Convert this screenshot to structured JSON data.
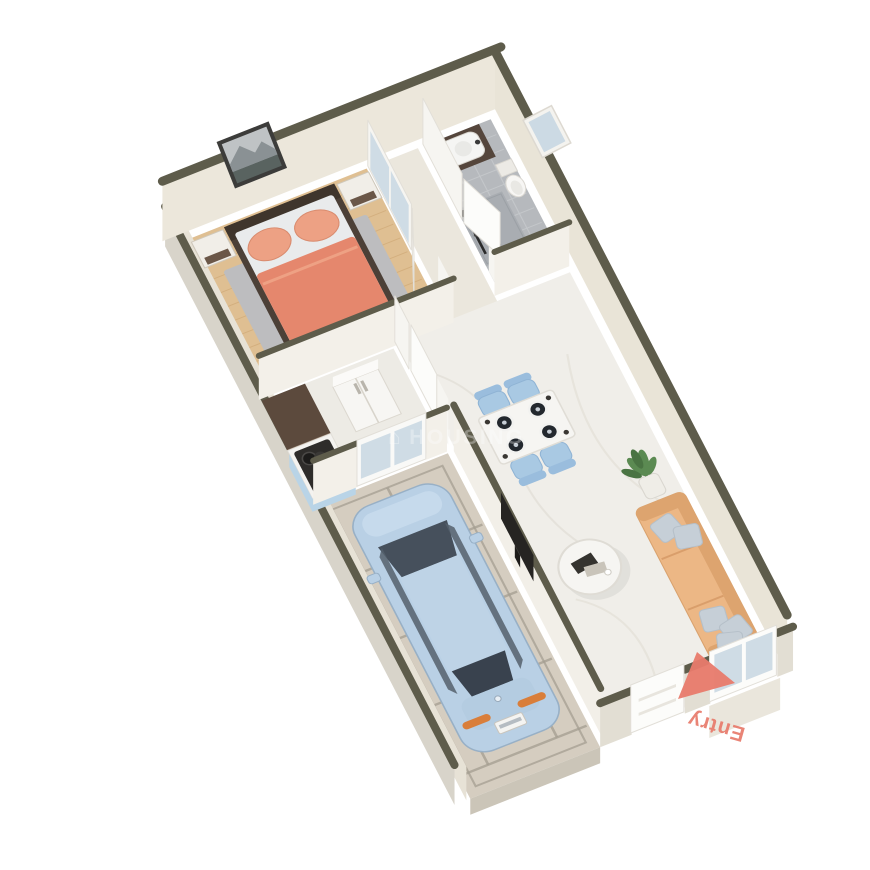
{
  "image": {
    "type": "3d-isometric-floorplan-render",
    "background": "#ffffff",
    "width": 870,
    "height": 870
  },
  "labels": {
    "entry": "Entry",
    "watermark": "HOUSING",
    "watermark_icon": "house-icon"
  },
  "entry_arrow": {
    "color": "#e87a6b",
    "description": "coral triangle pointing toward entry door on porch"
  },
  "rooms_depicted": [
    "bedroom",
    "wardrobe-hall",
    "bathroom",
    "kitchen",
    "dining-area",
    "living-room",
    "garage",
    "entry-porch"
  ],
  "objects_depicted": [
    "double-bed",
    "nightstands",
    "wall-art",
    "area-rug",
    "mirror-wardrobe",
    "shower",
    "vanity-sink",
    "toilet",
    "stove-counter",
    "refrigerator",
    "dining-table",
    "four-blue-chairs",
    "plates",
    "sofa",
    "throw-pillows",
    "potted-plant",
    "round-coffee-table",
    "books",
    "tv-panel",
    "light-blue-car",
    "paver-driveway",
    "glass-entry-door"
  ],
  "colors": {
    "wall_top": "#5e5c4b",
    "wall_face": "#ece7db",
    "wall_face_right": "#e9e4d7",
    "wall_inner_left": "#e7e2d6",
    "wall_outer": "#d8d4ca",
    "wall_bottom_face": "#e2ded3",
    "interior_wall": "#f6f5f1",
    "door_white": "#fcfcfa",
    "door_stroke": "#e2dfd8",
    "wood": "#dfbf92",
    "wood_line": "#c9a06c",
    "rug": "#bdbdbf",
    "bed": "#e5876d",
    "bed_pillow": "#eda184",
    "bedsheet": "#e9ebec",
    "bed_frame": "#4c4037",
    "art_frame": "#3c3c3a",
    "tile": "#b6b9bd",
    "tile_line": "#c6c9cc",
    "hall_floor": "#ebe7dd",
    "kitchen_floor": "#edebe5",
    "marble": "#f0eee9",
    "marble_vein": "#ddd9d0",
    "counter_brown": "#5c4a3d",
    "counter_white": "#f4f3f0",
    "stove": "#2e2c2a",
    "cabinet_blue": "#b9d4e7",
    "fridge": "#f7f6f3",
    "table_top": "#f6f5f2",
    "chair_blue": "#a9c9e3",
    "plate": "#23282e",
    "sofa": "#ecb785",
    "sofa_dark": "#dda46f",
    "pillow_gray": "#c6cfd7",
    "plant": "#5b8a52",
    "pot": "#efede7",
    "paver": "#d5cdc0",
    "paver_line": "#a49e91",
    "car": "#b9d0e5",
    "car_glass": "#46505c",
    "car_roof": "#bed3e6",
    "car_light": "#d97e3a",
    "tv": "#262422",
    "mirror_glass": "#ccdae4",
    "accent": "#e87a6b",
    "watermark": "#ffffff"
  }
}
